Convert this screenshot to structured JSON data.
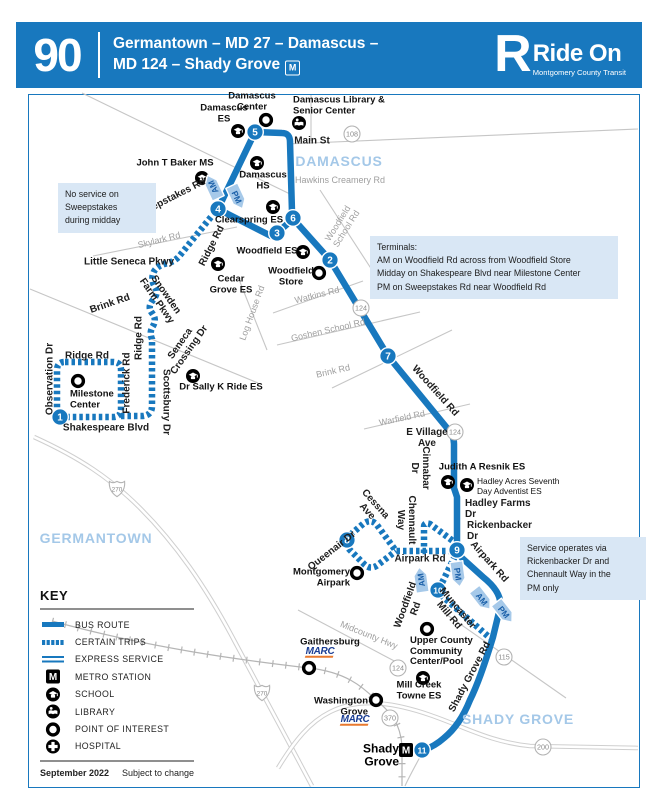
{
  "header": {
    "route_number": "90",
    "title_line1": "Germantown – MD 27 – Damascus –",
    "title_line2": "MD 124 – Shady Grove",
    "metro_symbol": "M",
    "brand": {
      "r": "R",
      "name": "Ride On",
      "tagline": "Montgomery County Transit"
    }
  },
  "colors": {
    "brand_blue": "#1878BE",
    "arrow_fill": "#A6C9E9",
    "arrow_text": "#1A5FA8",
    "note_bg": "#D9E7F5",
    "area_text": "#A4C8E8",
    "marc_blue": "#1B3E94",
    "marc_orange": "#E8792F"
  },
  "map": {
    "areas": [
      {
        "t": "DAMASCUS",
        "x": 339,
        "y": 161
      },
      {
        "t": "GERMANTOWN",
        "x": 96,
        "y": 538
      },
      {
        "t": "SHADY GROVE",
        "x": 518,
        "y": 719
      }
    ],
    "notes": [
      {
        "x": 58,
        "y": 183,
        "w": 84,
        "lines": [
          "No service on",
          "Sweepstakes",
          "during midday"
        ]
      },
      {
        "x": 370,
        "y": 236,
        "w": 234,
        "lines": [
          "Terminals:",
          "AM on Woodfield Rd across from Woodfield Store",
          "Midday on Shakespeare Blvd near Milestone Center",
          "PM on Sweepstakes Rd near Woodfield Rd"
        ]
      },
      {
        "x": 520,
        "y": 537,
        "w": 112,
        "lines": [
          "Service operates via",
          "Rickenbacker Dr and",
          "Chennault Way in the",
          "PM only"
        ]
      }
    ],
    "labels": [
      {
        "t": "Damascus\nCenter",
        "x": 252,
        "y": 102,
        "c": "p"
      },
      {
        "t": "Damascus\nES",
        "x": 224,
        "y": 114,
        "c": "p"
      },
      {
        "t": "Damascus Library &\nSenior Center",
        "x": 293,
        "y": 106,
        "c": "p",
        "a": "l"
      },
      {
        "t": "Main St",
        "x": 312,
        "y": 141,
        "c": "r"
      },
      {
        "t": "Hawkins Creamery Rd",
        "x": 340,
        "y": 180,
        "c": "g"
      },
      {
        "t": "John T Baker MS",
        "x": 175,
        "y": 164,
        "c": "p"
      },
      {
        "t": "Damascus\nHS",
        "x": 263,
        "y": 181,
        "c": "p"
      },
      {
        "t": "Sweepstakes Rd",
        "x": 170,
        "y": 199,
        "r": -27,
        "c": "r"
      },
      {
        "t": "Clearspring ES",
        "x": 249,
        "y": 221,
        "c": "p"
      },
      {
        "t": "Woodfield\nSchool Rd",
        "x": 342,
        "y": 226,
        "r": -58,
        "c": "g"
      },
      {
        "t": "Skylark Rd",
        "x": 159,
        "y": 240,
        "r": -14,
        "c": "g"
      },
      {
        "t": "Ridge Rd",
        "x": 212,
        "y": 246,
        "r": -63,
        "c": "r"
      },
      {
        "t": "Woodfield ES",
        "x": 267,
        "y": 252,
        "c": "p"
      },
      {
        "t": "Cedar\nGrove ES",
        "x": 231,
        "y": 285,
        "c": "p"
      },
      {
        "t": "Woodfield\nStore",
        "x": 291,
        "y": 277,
        "c": "p"
      },
      {
        "t": "Little Seneca Pkwy",
        "x": 129,
        "y": 262,
        "c": "r"
      },
      {
        "t": "Watkins Rd",
        "x": 317,
        "y": 295,
        "r": -14,
        "c": "g"
      },
      {
        "t": "Log House Rd",
        "x": 252,
        "y": 313,
        "r": -70,
        "c": "g"
      },
      {
        "t": "Snowden\nFarm Pkwy",
        "x": 161,
        "y": 298,
        "r": 55,
        "c": "r"
      },
      {
        "t": "Brink Rd",
        "x": 110,
        "y": 304,
        "r": -19,
        "c": "r"
      },
      {
        "t": "Goshen School Rd",
        "x": 328,
        "y": 330,
        "r": -13,
        "c": "g"
      },
      {
        "t": "Ridge Rd",
        "x": 139,
        "y": 338,
        "r": -90,
        "c": "r"
      },
      {
        "t": "Brink Rd",
        "x": 333,
        "y": 371,
        "r": -13,
        "c": "g"
      },
      {
        "t": "Ridge Rd",
        "x": 87,
        "y": 356,
        "c": "r"
      },
      {
        "t": "Observation Dr",
        "x": 50,
        "y": 379,
        "r": -90,
        "c": "r"
      },
      {
        "t": "Frederick Rd",
        "x": 127,
        "y": 383,
        "r": -90,
        "c": "r"
      },
      {
        "t": "Scottsbury Dr",
        "x": 166,
        "y": 402,
        "r": 90,
        "c": "r"
      },
      {
        "t": "Seneca\nCrossing Dr",
        "x": 185,
        "y": 347,
        "r": -55,
        "c": "r"
      },
      {
        "t": "Milestone\nCenter",
        "x": 70,
        "y": 400,
        "c": "p",
        "a": "l"
      },
      {
        "t": "Dr Sally K Ride ES",
        "x": 221,
        "y": 388,
        "c": "p"
      },
      {
        "t": "Shakespeare Blvd",
        "x": 106,
        "y": 428,
        "c": "r"
      },
      {
        "t": "Woodfield Rd",
        "x": 435,
        "y": 391,
        "r": 48,
        "c": "r"
      },
      {
        "t": "Warfield Rd",
        "x": 402,
        "y": 418,
        "r": -12,
        "c": "g"
      },
      {
        "t": "E Village\nAve",
        "x": 427,
        "y": 438,
        "c": "r"
      },
      {
        "t": "Cinnabar\nDr",
        "x": 420,
        "y": 468,
        "r": 90,
        "c": "r"
      },
      {
        "t": "Judith A Resnik ES",
        "x": 482,
        "y": 468,
        "c": "p"
      },
      {
        "t": "Hadley Acres Seventh\nDay Adventist ES",
        "x": 477,
        "y": 486,
        "c": "ps",
        "a": "l"
      },
      {
        "t": "Hadley Farms\nDr",
        "x": 465,
        "y": 509,
        "c": "r",
        "a": "l"
      },
      {
        "t": "Rickenbacker\nDr",
        "x": 467,
        "y": 531,
        "c": "r",
        "a": "l"
      },
      {
        "t": "Chennault\nWay",
        "x": 406,
        "y": 520,
        "r": 90,
        "c": "r"
      },
      {
        "t": "Cessna\nAve",
        "x": 371,
        "y": 508,
        "r": 48,
        "c": "r"
      },
      {
        "t": "Queenair Dr",
        "x": 332,
        "y": 551,
        "r": -38,
        "c": "r"
      },
      {
        "t": "Montgomery\nAirpark",
        "x": 350,
        "y": 578,
        "c": "p",
        "a": "r"
      },
      {
        "t": "Airpark Rd",
        "x": 420,
        "y": 559,
        "c": "r"
      },
      {
        "t": "Airpark Rd",
        "x": 489,
        "y": 562,
        "r": 48,
        "c": "r"
      },
      {
        "t": "Woodfield\nRd",
        "x": 411,
        "y": 607,
        "r": -70,
        "c": "r"
      },
      {
        "t": "Muncaster\nMill Rd",
        "x": 453,
        "y": 612,
        "r": 50,
        "c": "r"
      },
      {
        "t": "Midcounty Hwy",
        "x": 369,
        "y": 635,
        "r": 22,
        "c": "g"
      },
      {
        "t": "Gaithersburg",
        "x": 330,
        "y": 643,
        "c": "p"
      },
      {
        "t": "Upper County\nCommunity\nCenter/Pool",
        "x": 410,
        "y": 652,
        "c": "p",
        "a": "l"
      },
      {
        "t": "Mill Creek\nTowne ES",
        "x": 419,
        "y": 691,
        "c": "p"
      },
      {
        "t": "Shady Grove Rd",
        "x": 470,
        "y": 677,
        "r": -62,
        "c": "r"
      },
      {
        "t": "Washington\nGrove",
        "x": 368,
        "y": 707,
        "c": "p",
        "a": "r"
      },
      {
        "t": "Shady\nGrove",
        "x": 399,
        "y": 756,
        "c": "st",
        "a": "r"
      }
    ],
    "stops": [
      {
        "n": 1,
        "x": 60,
        "y": 417
      },
      {
        "n": 2,
        "x": 330,
        "y": 260
      },
      {
        "n": 3,
        "x": 277,
        "y": 233
      },
      {
        "n": 4,
        "x": 218,
        "y": 209
      },
      {
        "n": 5,
        "x": 255,
        "y": 132
      },
      {
        "n": 6,
        "x": 293,
        "y": 218
      },
      {
        "n": 7,
        "x": 388,
        "y": 356
      },
      {
        "n": 8,
        "x": 347,
        "y": 540
      },
      {
        "n": 9,
        "x": 457,
        "y": 550
      },
      {
        "n": 10,
        "x": 438,
        "y": 590
      },
      {
        "n": 11,
        "x": 422,
        "y": 750
      }
    ],
    "arrows": [
      {
        "t": "AM",
        "x": 213,
        "y": 187,
        "r": -25
      },
      {
        "t": "PM",
        "x": 237,
        "y": 197,
        "r": 155
      },
      {
        "t": "AM",
        "x": 421,
        "y": 580,
        "r": -8
      },
      {
        "t": "PM",
        "x": 458,
        "y": 574,
        "r": 172
      },
      {
        "t": "AM",
        "x": 482,
        "y": 599,
        "r": 142
      },
      {
        "t": "PM",
        "x": 504,
        "y": 612,
        "r": 142
      }
    ],
    "icons": [
      {
        "t": "school",
        "x": 238,
        "y": 131
      },
      {
        "t": "school",
        "x": 202,
        "y": 178
      },
      {
        "t": "school",
        "x": 257,
        "y": 163
      },
      {
        "t": "school",
        "x": 273,
        "y": 207
      },
      {
        "t": "school",
        "x": 303,
        "y": 252
      },
      {
        "t": "school",
        "x": 218,
        "y": 264
      },
      {
        "t": "school",
        "x": 193,
        "y": 376
      },
      {
        "t": "school",
        "x": 448,
        "y": 482
      },
      {
        "t": "school",
        "x": 467,
        "y": 485
      },
      {
        "t": "school",
        "x": 423,
        "y": 678
      },
      {
        "t": "library",
        "x": 299,
        "y": 123
      },
      {
        "t": "poi",
        "x": 266,
        "y": 120
      },
      {
        "t": "poi",
        "x": 319,
        "y": 273
      },
      {
        "t": "poi",
        "x": 78,
        "y": 381
      },
      {
        "t": "poi",
        "x": 357,
        "y": 573
      },
      {
        "t": "poi",
        "x": 427,
        "y": 629
      },
      {
        "t": "poi",
        "x": 309,
        "y": 668
      },
      {
        "t": "poi",
        "x": 376,
        "y": 700
      },
      {
        "t": "metro",
        "x": 406,
        "y": 750
      }
    ],
    "shields": [
      {
        "t": "108",
        "x": 352,
        "y": 134
      },
      {
        "t": "124",
        "x": 361,
        "y": 308
      },
      {
        "t": "124",
        "x": 455,
        "y": 432
      },
      {
        "t": "124",
        "x": 398,
        "y": 668
      },
      {
        "t": "115",
        "x": 504,
        "y": 657
      },
      {
        "t": "370",
        "x": 390,
        "y": 718
      },
      {
        "t": "200",
        "x": 543,
        "y": 747
      },
      {
        "t": "270",
        "x": 117,
        "y": 489,
        "i": 1
      },
      {
        "t": "270",
        "x": 262,
        "y": 693,
        "i": 1
      }
    ],
    "marc": [
      {
        "t": "MARC",
        "x": 320,
        "y": 654
      },
      {
        "t": "MARC",
        "x": 355,
        "y": 722
      }
    ]
  },
  "key": {
    "title": "KEY",
    "items": [
      {
        "swatch": "bus",
        "label": "BUS ROUTE"
      },
      {
        "swatch": "certain",
        "label": "CERTAIN TRIPS"
      },
      {
        "swatch": "express",
        "label": "EXPRESS SERVICE"
      },
      {
        "swatch": "metro",
        "label": "METRO STATION"
      },
      {
        "swatch": "school",
        "label": "SCHOOL"
      },
      {
        "swatch": "library",
        "label": "LIBRARY"
      },
      {
        "swatch": "poi",
        "label": "POINT OF INTEREST"
      },
      {
        "swatch": "hospital",
        "label": "HOSPITAL"
      }
    ],
    "footer_left": "September 2022",
    "footer_right": "Subject to change"
  }
}
